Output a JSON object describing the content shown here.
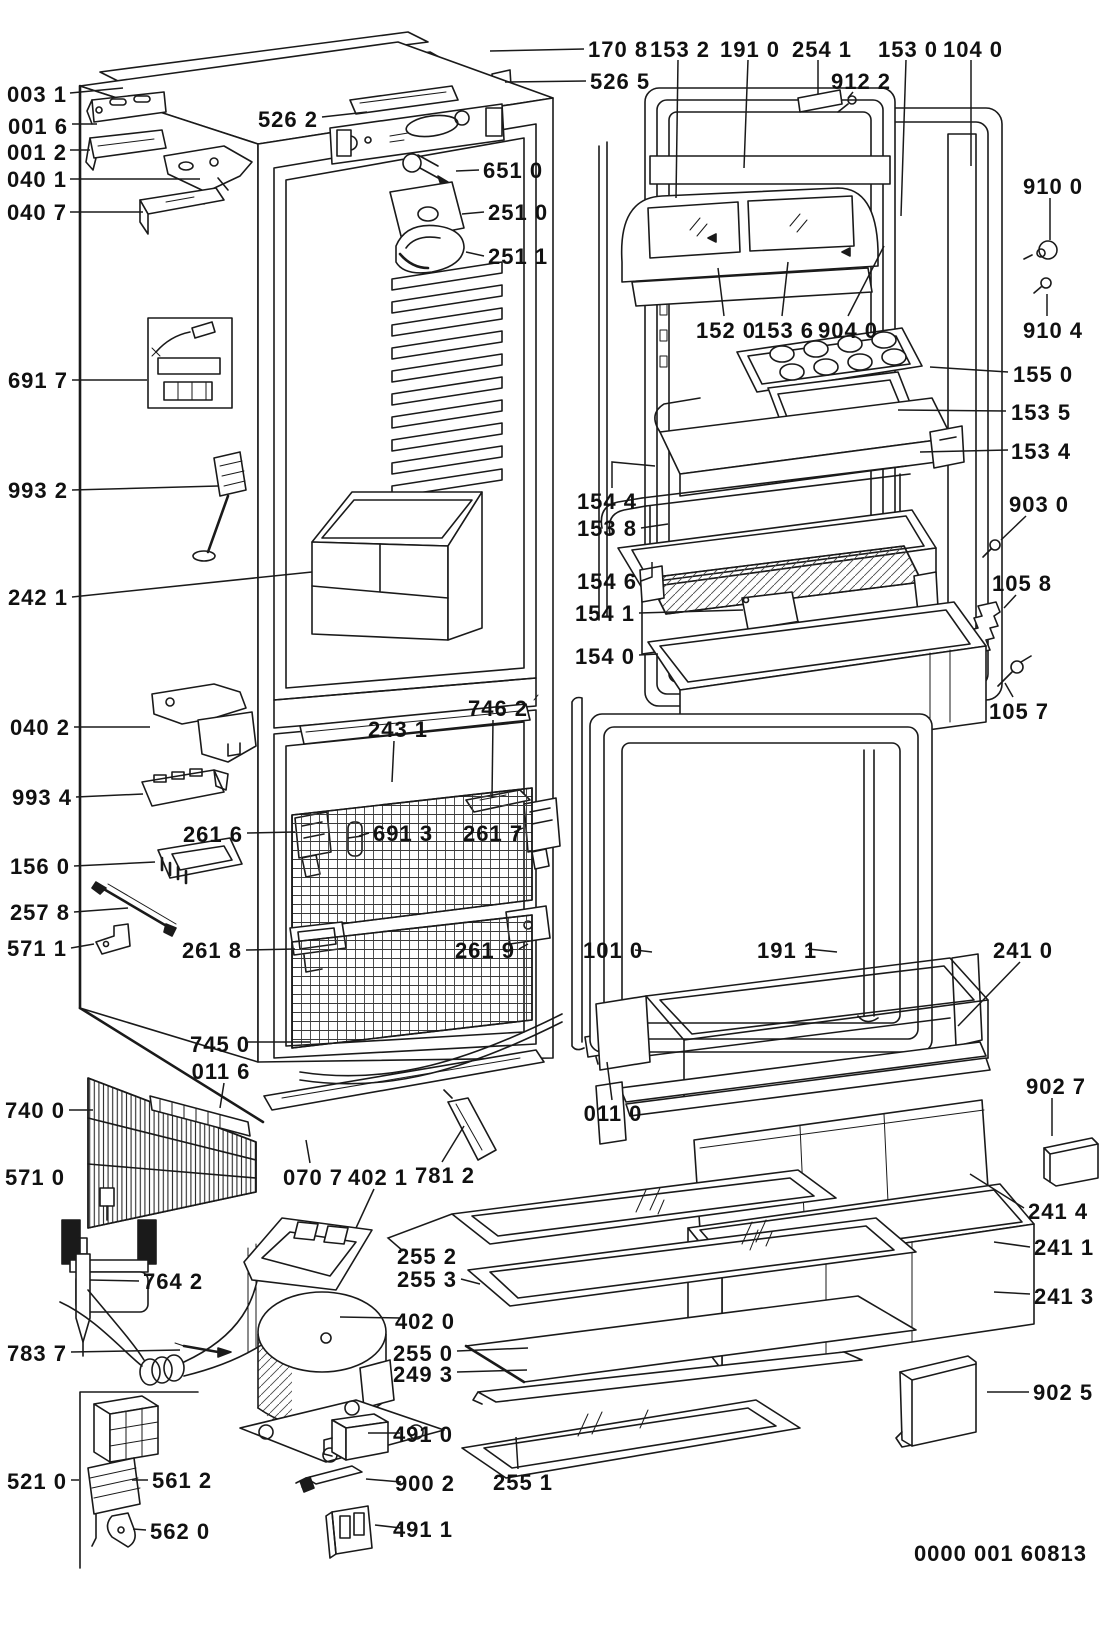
{
  "diagram": {
    "kind": "refrigerator exploded parts diagram",
    "doc_code": "0000 001 60813",
    "colors": {
      "line": "#1a1a1a",
      "background": "#ffffff"
    },
    "labels": [
      {
        "t": "003 1",
        "a": "end",
        "x": 67,
        "y": 94,
        "l": [
          [
            70,
            93
          ],
          [
            123,
            88
          ]
        ]
      },
      {
        "t": "001 6",
        "a": "end",
        "x": 68,
        "y": 126,
        "l": [
          [
            72,
            124
          ],
          [
            97,
            124
          ]
        ]
      },
      {
        "t": "001 2",
        "a": "end",
        "x": 67,
        "y": 152,
        "l": [
          [
            70,
            150
          ],
          [
            90,
            150
          ]
        ]
      },
      {
        "t": "040 1",
        "a": "end",
        "x": 67,
        "y": 179,
        "l": [
          [
            70,
            179
          ],
          [
            200,
            179
          ]
        ]
      },
      {
        "t": "040 7",
        "a": "end",
        "x": 67,
        "y": 212,
        "l": [
          [
            70,
            212
          ],
          [
            143,
            212
          ]
        ]
      },
      {
        "t": "526 2",
        "a": "end",
        "x": 318,
        "y": 119,
        "l": [
          [
            322,
            117
          ],
          [
            367,
            112
          ]
        ]
      },
      {
        "t": "170 8",
        "a": "start",
        "x": 588,
        "y": 49,
        "l": [
          [
            584,
            49
          ],
          [
            490,
            51
          ]
        ]
      },
      {
        "t": "526 5",
        "a": "start",
        "x": 590,
        "y": 81,
        "l": [
          [
            586,
            81
          ],
          [
            505,
            82
          ]
        ]
      },
      {
        "t": "651 0",
        "a": "start",
        "x": 483,
        "y": 170,
        "l": [
          [
            479,
            170
          ],
          [
            456,
            171
          ]
        ]
      },
      {
        "t": "251 0",
        "a": "start",
        "x": 488,
        "y": 212,
        "l": [
          [
            484,
            212
          ],
          [
            462,
            214
          ]
        ]
      },
      {
        "t": "251 1",
        "a": "start",
        "x": 488,
        "y": 256,
        "l": [
          [
            484,
            256
          ],
          [
            466,
            252
          ]
        ]
      },
      {
        "t": "153 2",
        "a": "middle",
        "x": 680,
        "y": 49,
        "l": [
          [
            678,
            60
          ],
          [
            676,
            198
          ]
        ]
      },
      {
        "t": "191 0",
        "a": "middle",
        "x": 750,
        "y": 49,
        "l": [
          [
            748,
            60
          ],
          [
            744,
            168
          ]
        ]
      },
      {
        "t": "254 1",
        "a": "middle",
        "x": 822,
        "y": 49,
        "l": [
          [
            818,
            60
          ],
          [
            818,
            94
          ]
        ]
      },
      {
        "t": "912 2",
        "a": "middle",
        "x": 861,
        "y": 81,
        "l": [
          [
            853,
            92
          ],
          [
            848,
            98
          ]
        ]
      },
      {
        "t": "153 0",
        "a": "middle",
        "x": 908,
        "y": 49,
        "l": [
          [
            906,
            60
          ],
          [
            901,
            216
          ]
        ]
      },
      {
        "t": "104 0",
        "a": "middle",
        "x": 973,
        "y": 49,
        "l": [
          [
            971,
            60
          ],
          [
            971,
            166
          ]
        ]
      },
      {
        "t": "910 0",
        "a": "middle",
        "x": 1053,
        "y": 186,
        "l": [
          [
            1050,
            198
          ],
          [
            1050,
            240
          ]
        ]
      },
      {
        "t": "910 4",
        "a": "middle",
        "x": 1053,
        "y": 330,
        "l": [
          [
            1047,
            316
          ],
          [
            1047,
            294
          ]
        ]
      },
      {
        "t": "152 0",
        "a": "middle",
        "x": 726,
        "y": 330,
        "l": [
          [
            724,
            316
          ],
          [
            718,
            268
          ]
        ]
      },
      {
        "t": "153 6",
        "a": "middle",
        "x": 784,
        "y": 330,
        "l": [
          [
            782,
            316
          ],
          [
            788,
            262
          ]
        ]
      },
      {
        "t": "904 0",
        "a": "middle",
        "x": 848,
        "y": 330,
        "l": [
          [
            848,
            316
          ],
          [
            884,
            246
          ]
        ]
      },
      {
        "t": "155 0",
        "a": "start",
        "x": 1013,
        "y": 374,
        "l": [
          [
            1008,
            372
          ],
          [
            930,
            367
          ]
        ]
      },
      {
        "t": "153 5",
        "a": "start",
        "x": 1011,
        "y": 412,
        "l": [
          [
            1006,
            411
          ],
          [
            898,
            410
          ]
        ]
      },
      {
        "t": "153 4",
        "a": "start",
        "x": 1011,
        "y": 451,
        "l": [
          [
            1008,
            450
          ],
          [
            920,
            452
          ]
        ]
      },
      {
        "t": "903 0",
        "a": "middle",
        "x": 1039,
        "y": 504,
        "l": [
          [
            1026,
            516
          ],
          [
            1001,
            540
          ]
        ]
      },
      {
        "t": "105 8",
        "a": "middle",
        "x": 1022,
        "y": 583,
        "l": [
          [
            1016,
            595
          ],
          [
            1004,
            608
          ]
        ]
      },
      {
        "t": "105 7",
        "a": "middle",
        "x": 1019,
        "y": 711,
        "l": [
          [
            1013,
            697
          ],
          [
            1005,
            683
          ]
        ]
      },
      {
        "t": "154 4",
        "a": "end",
        "x": 637,
        "y": 501,
        "l": [
          [
            612,
            488
          ],
          [
            612,
            462
          ],
          [
            655,
            466
          ]
        ]
      },
      {
        "t": "153 8",
        "a": "end",
        "x": 637,
        "y": 528,
        "l": [
          [
            641,
            528
          ],
          [
            668,
            524
          ]
        ]
      },
      {
        "t": "154 6",
        "a": "end",
        "x": 637,
        "y": 581,
        "l": [
          [
            641,
            581
          ],
          [
            652,
            577
          ],
          [
            652,
            562
          ]
        ]
      },
      {
        "t": "154 1",
        "a": "end",
        "x": 635,
        "y": 613,
        "l": [
          [
            639,
            613
          ],
          [
            743,
            610
          ]
        ]
      },
      {
        "t": "154 0",
        "a": "end",
        "x": 635,
        "y": 656,
        "l": [
          [
            639,
            655
          ],
          [
            658,
            654
          ]
        ]
      },
      {
        "t": "691 7",
        "a": "end",
        "x": 68,
        "y": 380,
        "l": [
          [
            72,
            380
          ],
          [
            147,
            380
          ]
        ]
      },
      {
        "t": "993 2",
        "a": "end",
        "x": 68,
        "y": 490,
        "l": [
          [
            72,
            490
          ],
          [
            218,
            486
          ]
        ]
      },
      {
        "t": "242 1",
        "a": "end",
        "x": 68,
        "y": 597,
        "l": [
          [
            72,
            597
          ],
          [
            312,
            572
          ]
        ]
      },
      {
        "t": "040 2",
        "a": "end",
        "x": 70,
        "y": 727,
        "l": [
          [
            74,
            727
          ],
          [
            150,
            727
          ]
        ]
      },
      {
        "t": "993 4",
        "a": "end",
        "x": 72,
        "y": 797,
        "l": [
          [
            76,
            797
          ],
          [
            143,
            794
          ]
        ]
      },
      {
        "t": "156 0",
        "a": "end",
        "x": 70,
        "y": 866,
        "l": [
          [
            74,
            866
          ],
          [
            155,
            862
          ]
        ]
      },
      {
        "t": "257 8",
        "a": "end",
        "x": 70,
        "y": 912,
        "l": [
          [
            74,
            912
          ],
          [
            128,
            908
          ]
        ]
      },
      {
        "t": "571 1",
        "a": "end",
        "x": 67,
        "y": 948,
        "l": [
          [
            71,
            948
          ],
          [
            94,
            944
          ]
        ]
      },
      {
        "t": "261 6",
        "a": "end",
        "x": 243,
        "y": 834,
        "l": [
          [
            247,
            833
          ],
          [
            295,
            832
          ]
        ]
      },
      {
        "t": "691 3",
        "a": "start",
        "x": 373,
        "y": 833,
        "l": [
          [
            369,
            833
          ],
          [
            359,
            836
          ]
        ]
      },
      {
        "t": "261 7",
        "a": "start",
        "x": 463,
        "y": 833,
        "l": [
          [
            514,
            832
          ],
          [
            523,
            828
          ]
        ]
      },
      {
        "t": "746 2",
        "a": "middle",
        "x": 498,
        "y": 708,
        "l": [
          [
            493,
            720
          ],
          [
            492,
            798
          ]
        ]
      },
      {
        "t": "243 1",
        "a": "middle",
        "x": 398,
        "y": 729,
        "l": [
          [
            394,
            741
          ],
          [
            392,
            782
          ]
        ]
      },
      {
        "t": "261 8",
        "a": "end",
        "x": 242,
        "y": 950,
        "l": [
          [
            246,
            950
          ],
          [
            295,
            949
          ]
        ]
      },
      {
        "t": "261 9",
        "a": "end",
        "x": 515,
        "y": 950,
        "l": [
          [
            519,
            949
          ],
          [
            528,
            944
          ]
        ]
      },
      {
        "t": "101 0",
        "a": "start",
        "x": 583,
        "y": 950,
        "l": [
          [
            635,
            950
          ],
          [
            652,
            952
          ]
        ]
      },
      {
        "t": "191 1",
        "a": "start",
        "x": 757,
        "y": 950,
        "l": [
          [
            808,
            949
          ],
          [
            837,
            952
          ]
        ]
      },
      {
        "t": "241 0",
        "a": "middle",
        "x": 1023,
        "y": 950,
        "l": [
          [
            1020,
            962
          ],
          [
            958,
            1026
          ]
        ]
      },
      {
        "t": "745 0",
        "a": "middle",
        "x": 220,
        "y": 1044,
        "l": [
          [
            248,
            1042
          ],
          [
            310,
            1042
          ]
        ]
      },
      {
        "t": "011 6",
        "a": "middle",
        "x": 221,
        "y": 1071,
        "l": [
          [
            224,
            1083
          ],
          [
            220,
            1108
          ]
        ]
      },
      {
        "t": "740 0",
        "a": "end",
        "x": 65,
        "y": 1110,
        "l": [
          [
            69,
            1110
          ],
          [
            93,
            1110
          ]
        ]
      },
      {
        "t": "571 0",
        "a": "end",
        "x": 65,
        "y": 1177
      },
      {
        "t": "070 7",
        "a": "middle",
        "x": 313,
        "y": 1177,
        "l": [
          [
            310,
            1163
          ],
          [
            306,
            1140
          ]
        ]
      },
      {
        "t": "402 1",
        "a": "middle",
        "x": 378,
        "y": 1177,
        "l": [
          [
            374,
            1189
          ],
          [
            356,
            1228
          ]
        ]
      },
      {
        "t": "781 2",
        "a": "middle",
        "x": 445,
        "y": 1175,
        "l": [
          [
            442,
            1162
          ],
          [
            464,
            1126
          ]
        ]
      },
      {
        "t": "011 0",
        "a": "middle",
        "x": 613,
        "y": 1113,
        "l": [
          [
            612,
            1100
          ],
          [
            607,
            1062
          ]
        ]
      },
      {
        "t": "255 2",
        "a": "end",
        "x": 457,
        "y": 1256,
        "l": [
          [
            403,
            1251
          ],
          [
            388,
            1238
          ],
          [
            452,
            1214
          ]
        ]
      },
      {
        "t": "255 3",
        "a": "end",
        "x": 457,
        "y": 1279,
        "l": [
          [
            461,
            1279
          ],
          [
            480,
            1284
          ]
        ]
      },
      {
        "t": "402 0",
        "a": "end",
        "x": 455,
        "y": 1321,
        "l": [
          [
            401,
            1318
          ],
          [
            340,
            1317
          ]
        ]
      },
      {
        "t": "255 0",
        "a": "end",
        "x": 453,
        "y": 1353,
        "l": [
          [
            457,
            1351
          ],
          [
            528,
            1348
          ]
        ]
      },
      {
        "t": "249 3",
        "a": "end",
        "x": 453,
        "y": 1374,
        "l": [
          [
            457,
            1372
          ],
          [
            527,
            1370
          ]
        ]
      },
      {
        "t": "491 0",
        "a": "end",
        "x": 453,
        "y": 1434,
        "l": [
          [
            400,
            1433
          ],
          [
            368,
            1433
          ]
        ]
      },
      {
        "t": "900 2",
        "a": "end",
        "x": 455,
        "y": 1483,
        "l": [
          [
            401,
            1482
          ],
          [
            366,
            1479
          ]
        ]
      },
      {
        "t": "491 1",
        "a": "end",
        "x": 453,
        "y": 1529,
        "l": [
          [
            401,
            1528
          ],
          [
            375,
            1525
          ]
        ]
      },
      {
        "t": "255 1",
        "a": "middle",
        "x": 523,
        "y": 1482,
        "l": [
          [
            518,
            1469
          ],
          [
            516,
            1437
          ]
        ]
      },
      {
        "t": "764 2",
        "a": "start",
        "x": 143,
        "y": 1281,
        "l": [
          [
            139,
            1281
          ],
          [
            90,
            1280
          ]
        ]
      },
      {
        "t": "783 7",
        "a": "end",
        "x": 67,
        "y": 1353,
        "l": [
          [
            71,
            1352
          ],
          [
            180,
            1350
          ]
        ]
      },
      {
        "t": "521 0",
        "a": "end",
        "x": 67,
        "y": 1481,
        "l": [
          [
            71,
            1480
          ],
          [
            79,
            1480
          ]
        ]
      },
      {
        "t": "561 2",
        "a": "start",
        "x": 152,
        "y": 1480,
        "l": [
          [
            148,
            1480
          ],
          [
            132,
            1480
          ]
        ]
      },
      {
        "t": "562 0",
        "a": "start",
        "x": 150,
        "y": 1531,
        "l": [
          [
            146,
            1530
          ],
          [
            133,
            1529
          ]
        ]
      },
      {
        "t": "902 7",
        "a": "middle",
        "x": 1056,
        "y": 1086,
        "l": [
          [
            1052,
            1098
          ],
          [
            1052,
            1136
          ]
        ]
      },
      {
        "t": "241 4",
        "a": "start",
        "x": 1028,
        "y": 1211,
        "l": [
          [
            1024,
            1208
          ],
          [
            970,
            1174
          ]
        ]
      },
      {
        "t": "241 1",
        "a": "start",
        "x": 1034,
        "y": 1247,
        "l": [
          [
            1030,
            1247
          ],
          [
            994,
            1242
          ]
        ]
      },
      {
        "t": "241 3",
        "a": "start",
        "x": 1034,
        "y": 1296,
        "l": [
          [
            1030,
            1294
          ],
          [
            994,
            1292
          ]
        ]
      },
      {
        "t": "902 5",
        "a": "start",
        "x": 1033,
        "y": 1392,
        "l": [
          [
            1029,
            1392
          ],
          [
            987,
            1392
          ]
        ]
      },
      {
        "t": "0000 001 60813",
        "a": "end",
        "x": 1087,
        "y": 1553
      }
    ]
  }
}
